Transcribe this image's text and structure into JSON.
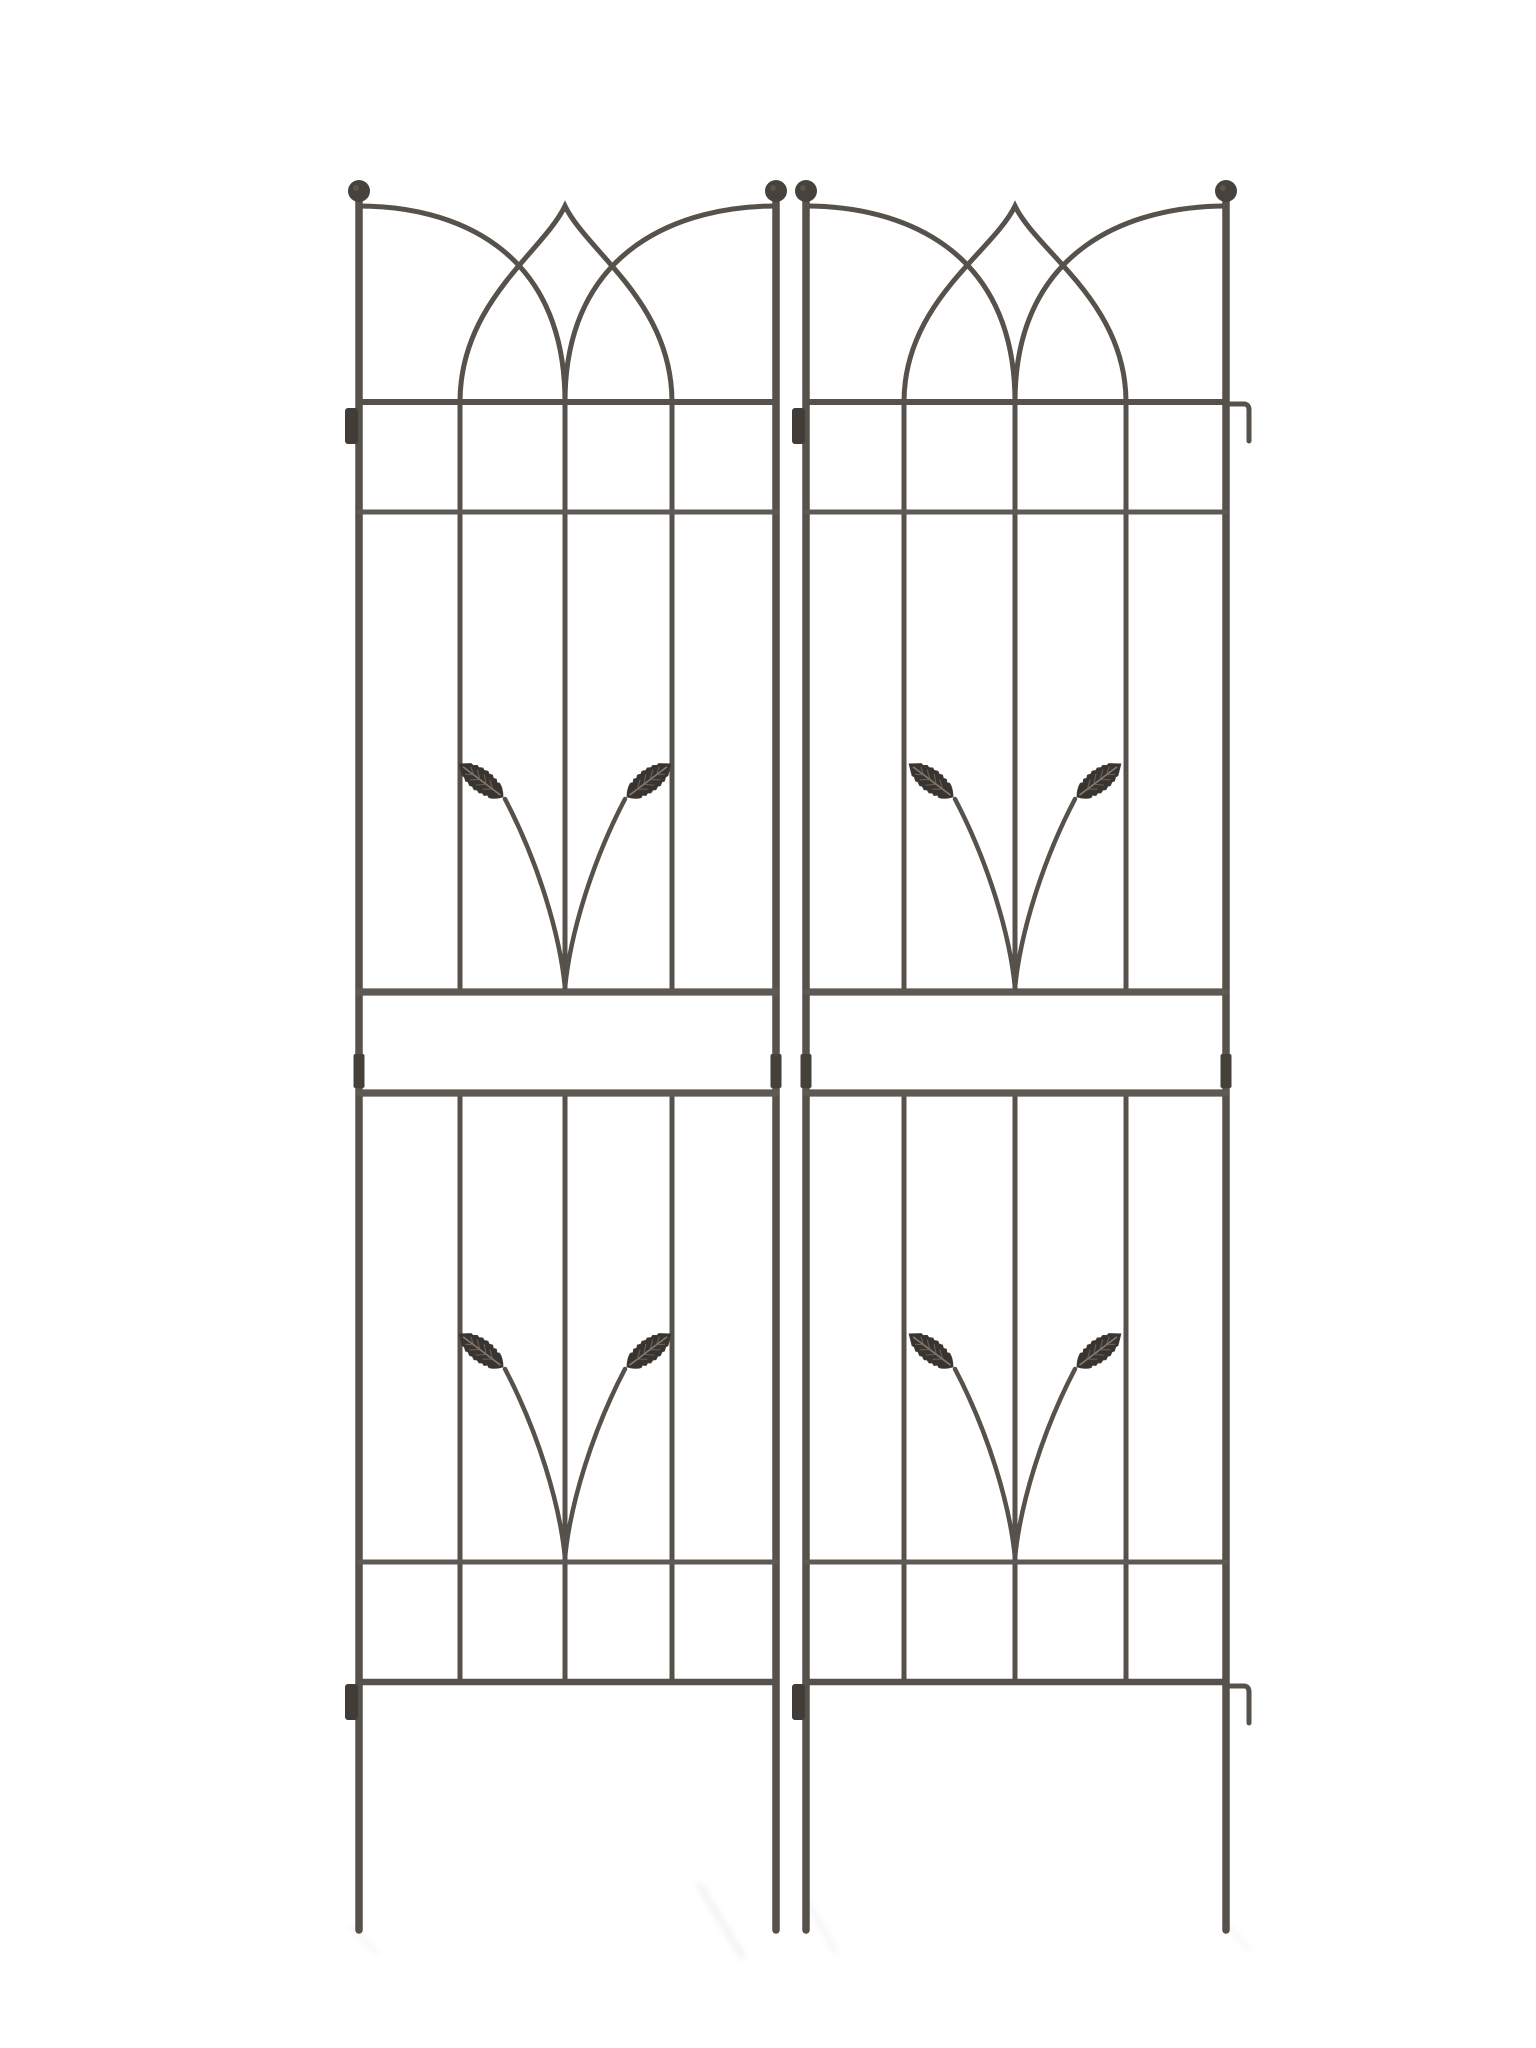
{
  "scene": {
    "type": "product-photo",
    "subject": "Pair of dark wrought-iron garden trellis panels with gothic arch tops, grid bars and leaf-scroll motifs on a white background",
    "background_color": "#ffffff",
    "canvas": {
      "width": 1536,
      "height": 2048
    }
  },
  "palette": {
    "metal": "#56514b",
    "metal_dark": "#413c37",
    "metal_light": "#6e6860",
    "band": "#5e5952",
    "leaf": "#393430",
    "leaf_rib": "#8b8379",
    "leaf_vein": "#776f66",
    "finial": "#47423c",
    "sleeve": "#45403a",
    "shadow": "#8e8e8c"
  },
  "stroke_widths": {
    "rail": 7.5,
    "inner_bar": 5,
    "arch": 5,
    "top_bar": 6,
    "strip": 5,
    "band_bar": 7.2,
    "bottom_bar": 6.5,
    "stem": 4.5,
    "hook": 5
  },
  "layout": {
    "finial_center_y": 191,
    "finial_radius": 11,
    "rail_top_y": 201,
    "lancet_apex_y": 206,
    "arch_spring_y": 206,
    "top_bar_y": 402,
    "upper_strip_y": 512,
    "band_top_y": 992,
    "band_bottom_y": 1093,
    "sleeve_y": 1054,
    "sleeve_h": 34,
    "sleeve_w": 11,
    "lower_strip_y": 1562,
    "bottom_bar_y": 1682,
    "leg_bottom_y": 1930,
    "upper_motif_spring_y": 988,
    "upper_leaf_base_y": 797,
    "lower_motif_spring_y": 1558,
    "lower_leaf_base_y": 1367,
    "leaf_base_dx": 62,
    "leaf_length": 55,
    "leaf_half_width": 11.5,
    "leaf_angle_left": -143,
    "leaf_angle_right": -37,
    "tab": {
      "w": 13,
      "h": 36,
      "top_y": 408,
      "bottom_y": 1684,
      "rx": 3
    },
    "hook": {
      "arm": 19,
      "drop": 31,
      "top_y": 404,
      "bottom_y": 1686
    }
  },
  "panels": [
    {
      "name": "left-panel",
      "x_left": 359,
      "x_right": 776,
      "inner_bars": [
        460,
        565,
        672
      ],
      "left_tab": true,
      "right_hook": false
    },
    {
      "name": "right-panel",
      "x_left": 806,
      "x_right": 1226,
      "inner_bars": [
        904,
        1015,
        1126
      ],
      "left_tab": true,
      "right_hook": true
    }
  ],
  "ground_shadows": [
    {
      "x1": 700,
      "y1": 1886,
      "x2": 742,
      "y2": 1956,
      "w": 7,
      "opacity": 0.1
    },
    {
      "x1": 806,
      "y1": 1900,
      "x2": 836,
      "y2": 1952,
      "w": 6,
      "opacity": 0.08
    },
    {
      "x1": 352,
      "y1": 1928,
      "x2": 376,
      "y2": 1952,
      "w": 5,
      "opacity": 0.07
    },
    {
      "x1": 1228,
      "y1": 1926,
      "x2": 1248,
      "y2": 1948,
      "w": 5,
      "opacity": 0.07
    }
  ]
}
